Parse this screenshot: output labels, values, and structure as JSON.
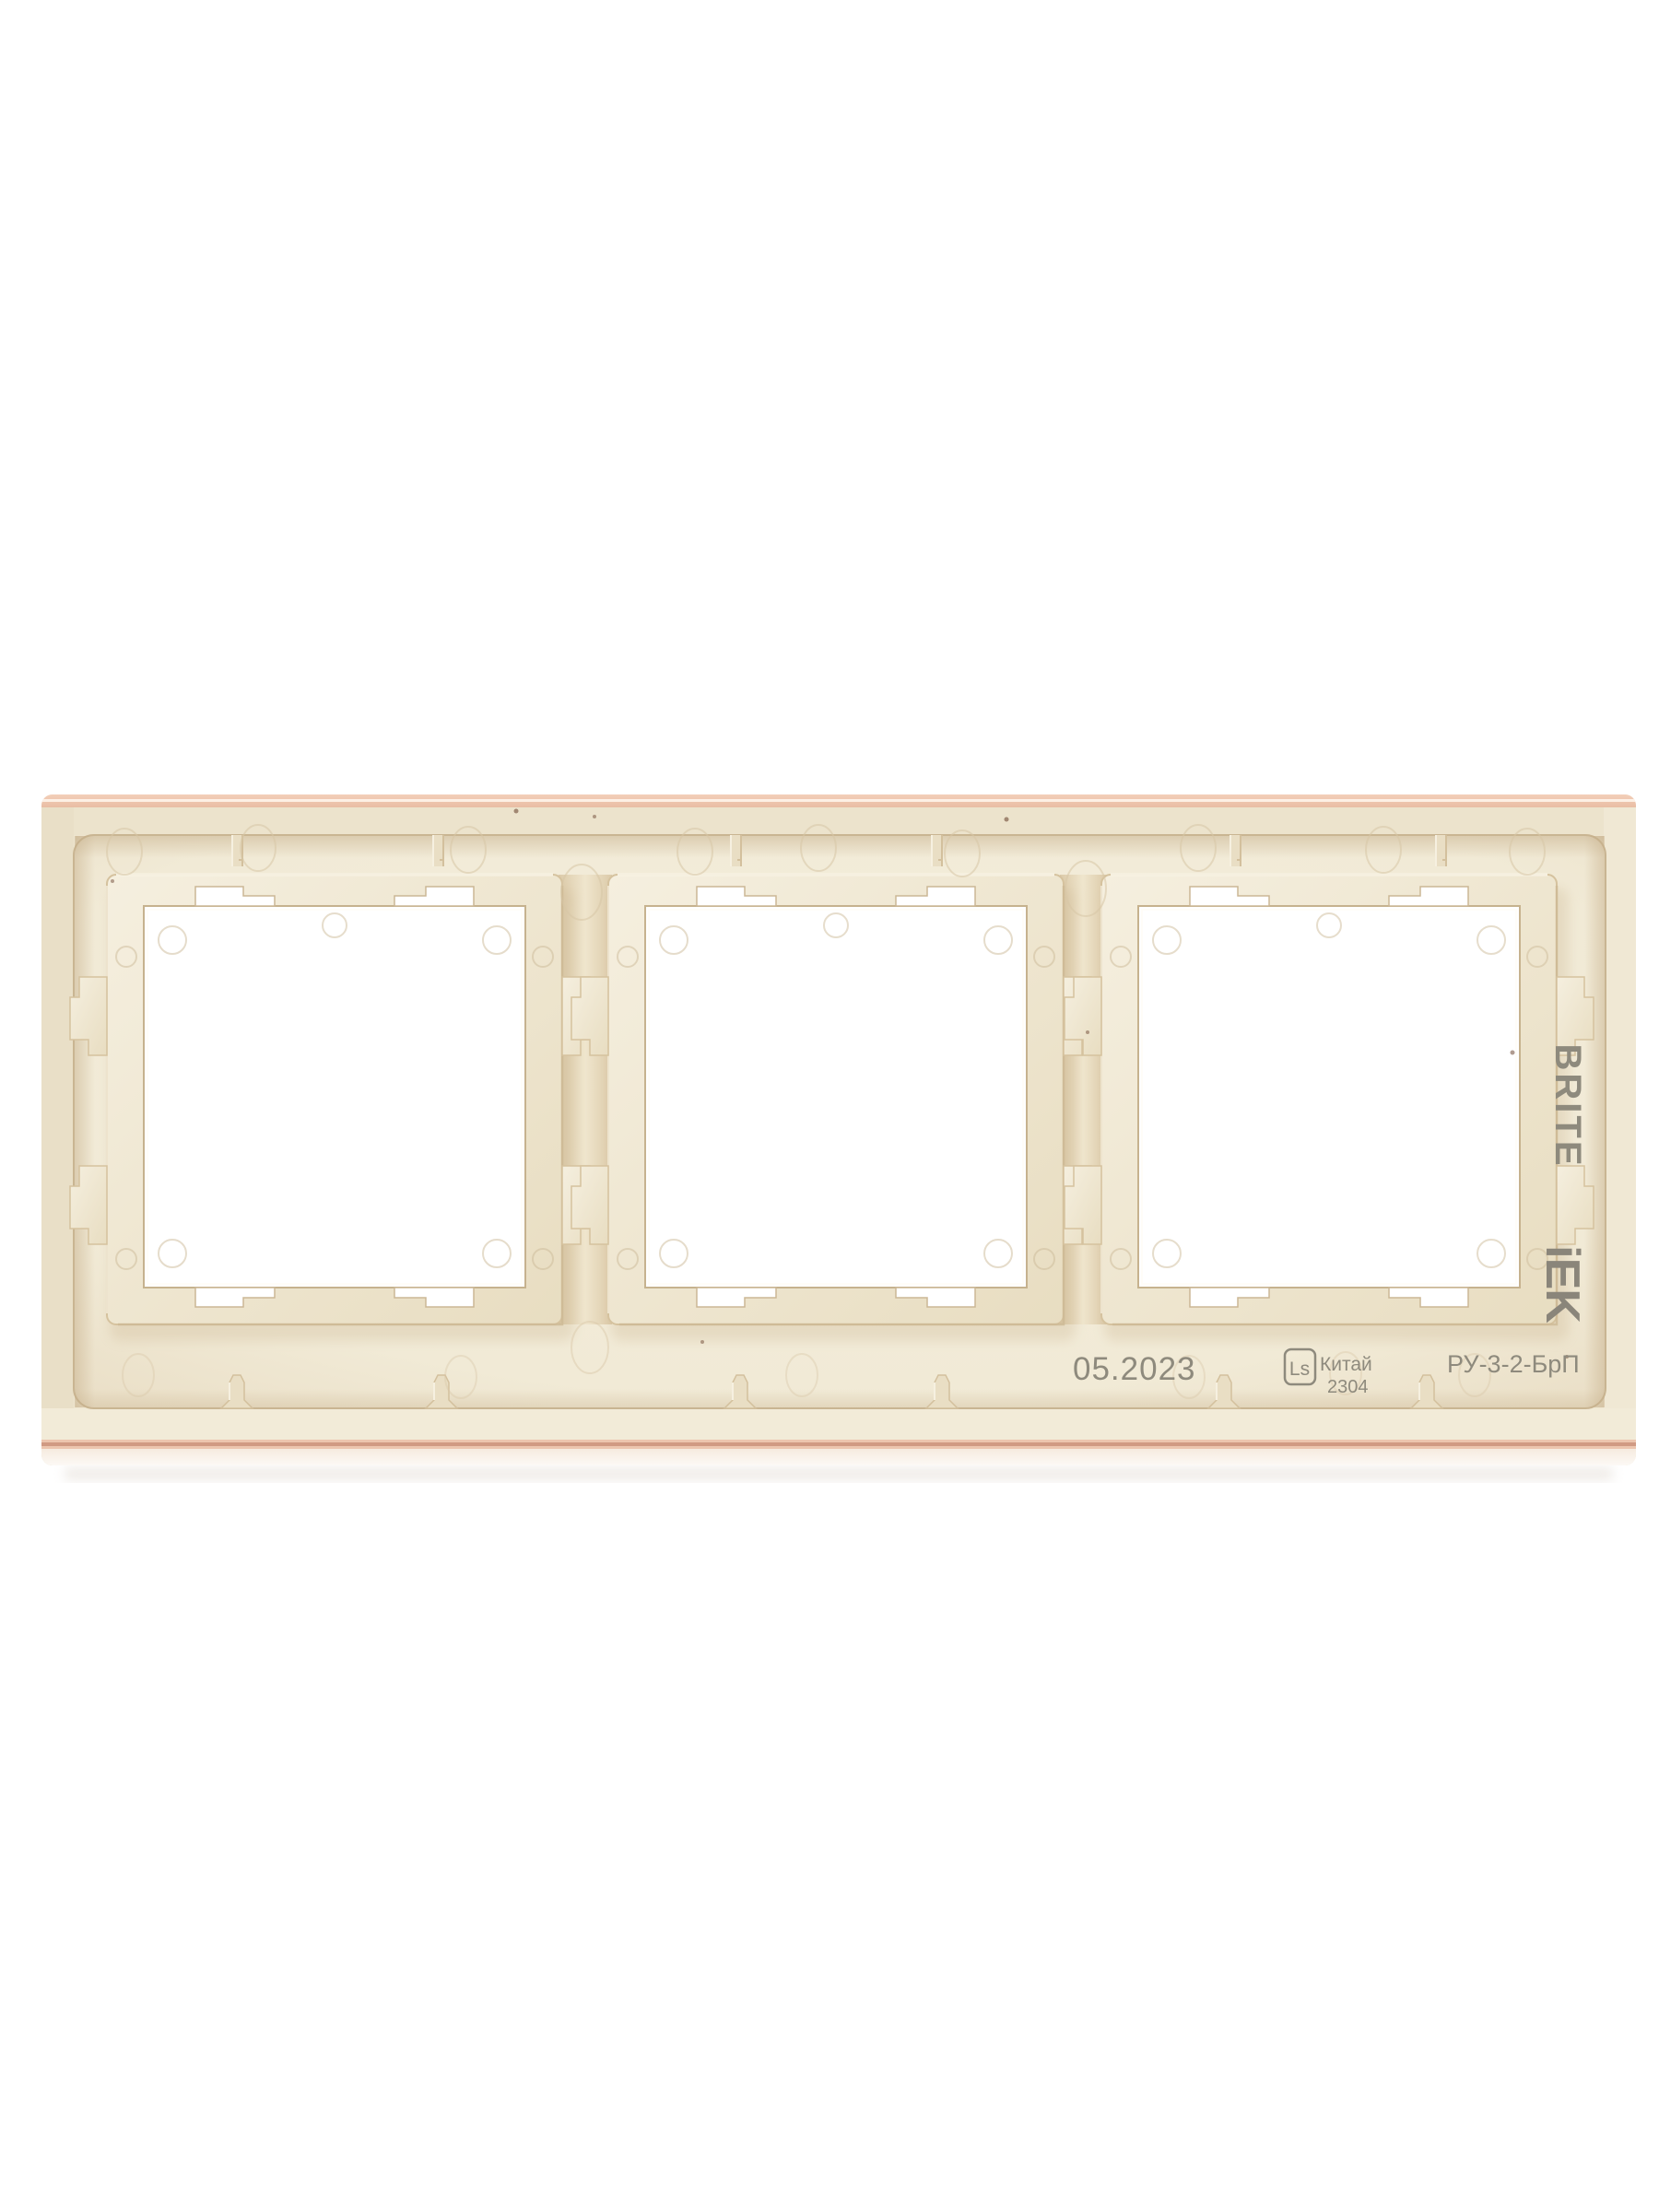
{
  "product": {
    "brand": "BRITE",
    "manufacturer_logo": "iEK",
    "date_code": "05.2023",
    "mold_badge": "Ls",
    "country": "Китай",
    "batch": "2304",
    "model": "РУ-3-2-БрП",
    "openings_count": "3"
  },
  "colors": {
    "background": "#ffffff",
    "plastic_body": "#eee5cf",
    "plastic_field": "#f3edda",
    "plastic_collar": "#ede3cb",
    "plastic_shadow": "#d5c29e",
    "plastic_highlight": "#f8f3e6",
    "edge_pink": "#ecc5ae",
    "edge_maroon": "#c98f78",
    "engraving_gray": "#8e8a7d",
    "opening_white": "#ffffff"
  }
}
